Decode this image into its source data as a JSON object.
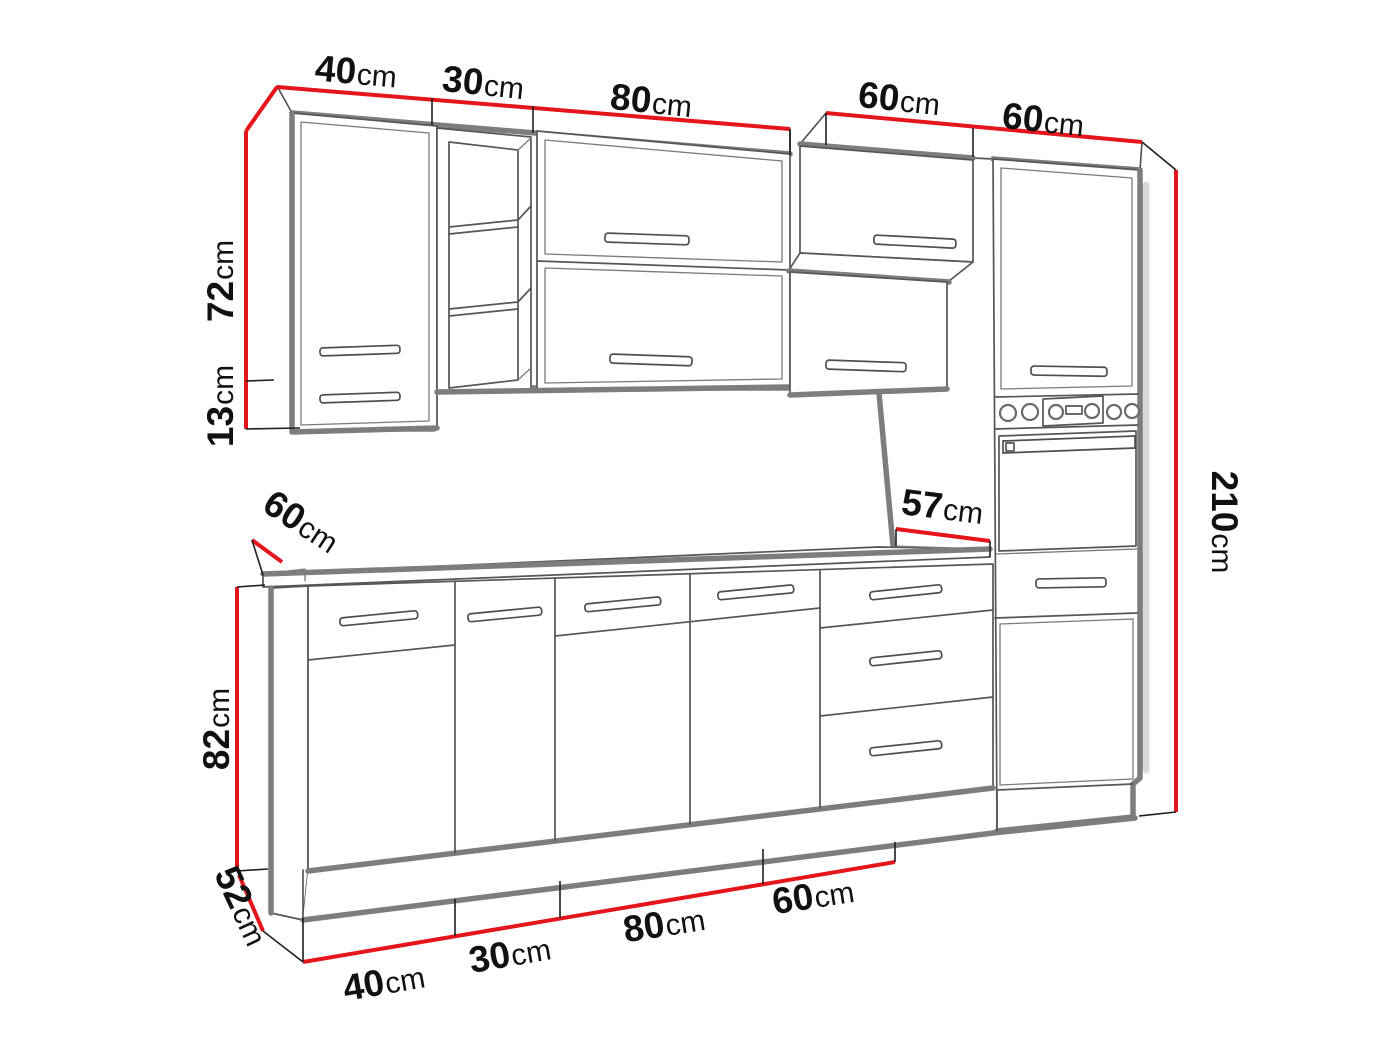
{
  "figure": {
    "type": "kitchen-cabinet-set-dimension-diagram"
  },
  "colors": {
    "dimension_line": "#e4151b",
    "label": "#111111",
    "sketch": "#565656",
    "edge": "#7d7d7d"
  },
  "dimensions": {
    "top": [
      {
        "value": "40",
        "unit": "cm"
      },
      {
        "value": "30",
        "unit": "cm"
      },
      {
        "value": "80",
        "unit": "cm"
      },
      {
        "value": "60",
        "unit": "cm"
      },
      {
        "value": "60",
        "unit": "cm"
      }
    ],
    "left": [
      {
        "value": "72",
        "unit": "cm"
      },
      {
        "value": "13",
        "unit": "cm"
      },
      {
        "value": "82",
        "unit": "cm"
      },
      {
        "value": "52",
        "unit": "cm"
      }
    ],
    "right": [
      {
        "value": "210",
        "unit": "cm"
      }
    ],
    "middle": [
      {
        "value": "60",
        "unit": "cm"
      },
      {
        "value": "57",
        "unit": "cm"
      }
    ],
    "bottom": [
      {
        "value": "40",
        "unit": "cm"
      },
      {
        "value": "30",
        "unit": "cm"
      },
      {
        "value": "80",
        "unit": "cm"
      },
      {
        "value": "60",
        "unit": "cm"
      }
    ]
  }
}
